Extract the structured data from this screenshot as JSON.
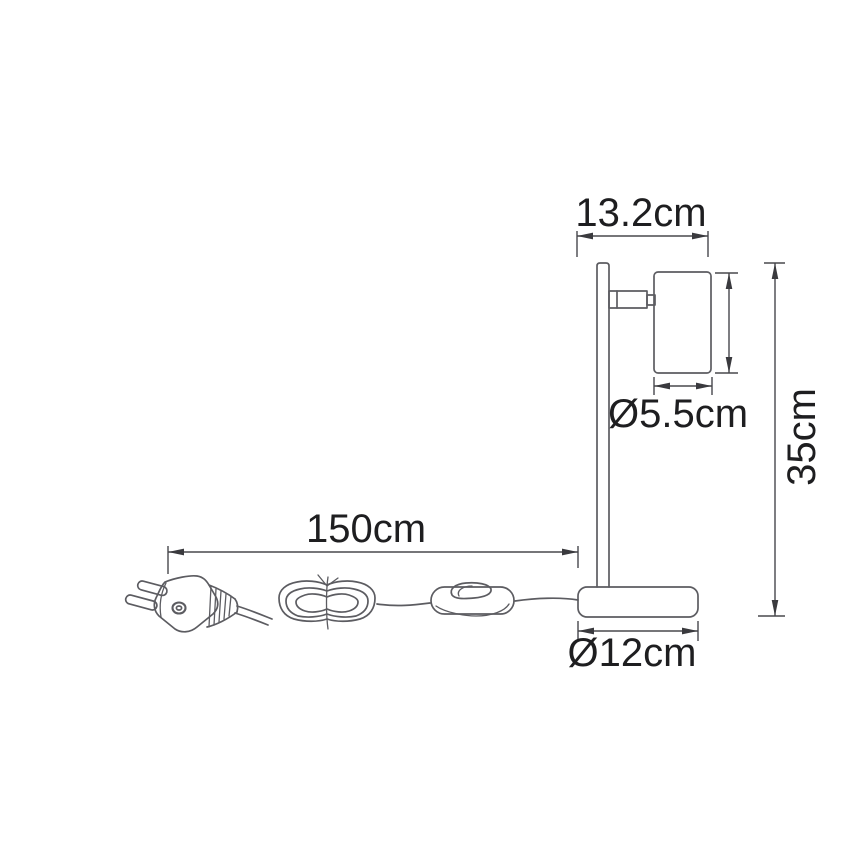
{
  "labels": {
    "head_width": "13.2cm",
    "head_diameter": "Ø5.5cm",
    "total_height": "35cm",
    "cable_length": "150cm",
    "base_diameter": "Ø12cm"
  },
  "colors": {
    "background": "#ffffff",
    "object_line": "#5c5c61",
    "dimension_line": "#48484d",
    "label_text": "#1e1e20"
  }
}
